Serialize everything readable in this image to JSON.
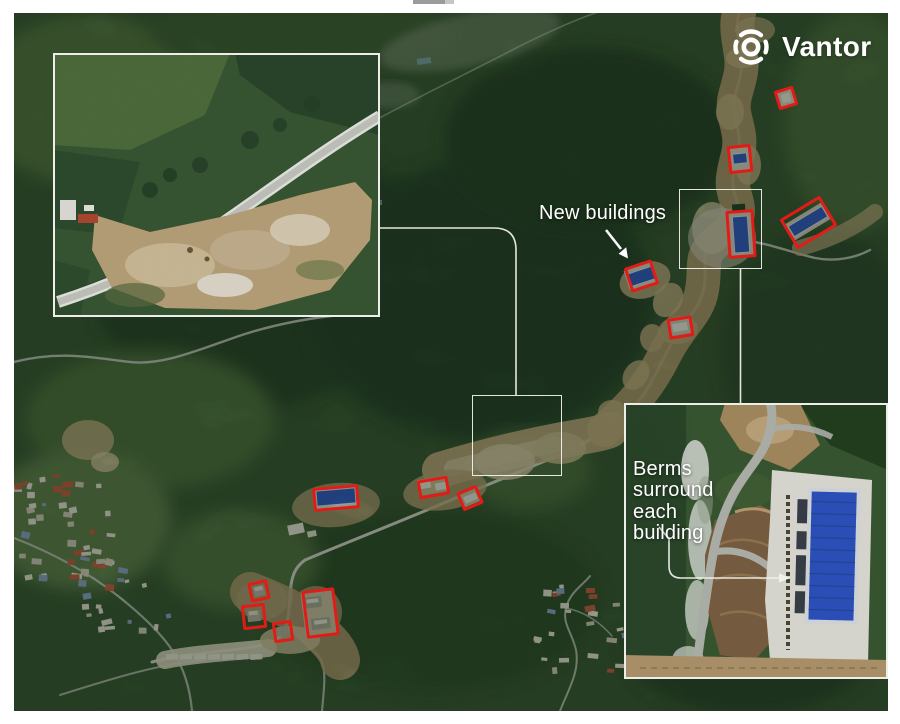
{
  "page": {
    "background_color": "#ffffff"
  },
  "logo": {
    "text": "Vantor",
    "icon": "vantor-aperture-icon",
    "color": "#ffffff"
  },
  "annotations": {
    "new_buildings_label": "New buildings",
    "berms_label": "Berms surround each building",
    "highlight_color": "#e31b17",
    "callout_color": "#f2f3ee",
    "red_boxes": [
      {
        "cx": 786,
        "cy": 98,
        "w": 20,
        "h": 20,
        "rot": -17
      },
      {
        "cx": 740,
        "cy": 159,
        "w": 24,
        "h": 28,
        "rot": -6
      },
      {
        "cx": 741,
        "cy": 234,
        "w": 28,
        "h": 48,
        "rot": -4
      },
      {
        "cx": 808,
        "cy": 222,
        "w": 47,
        "h": 35,
        "rot": -31
      },
      {
        "cx": 641,
        "cy": 276,
        "w": 29,
        "h": 26,
        "rot": -18
      },
      {
        "cx": 680,
        "cy": 327,
        "w": 25,
        "h": 21,
        "rot": -9
      },
      {
        "cx": 336,
        "cy": 498,
        "w": 46,
        "h": 24,
        "rot": -5
      },
      {
        "cx": 433,
        "cy": 487,
        "w": 31,
        "h": 19,
        "rot": -10
      },
      {
        "cx": 470,
        "cy": 498,
        "w": 22,
        "h": 20,
        "rot": -23
      },
      {
        "cx": 259,
        "cy": 591,
        "w": 20,
        "h": 20,
        "rot": -12
      },
      {
        "cx": 254,
        "cy": 616,
        "w": 24,
        "h": 25,
        "rot": -6
      },
      {
        "cx": 283,
        "cy": 631,
        "w": 20,
        "h": 21,
        "rot": -8
      },
      {
        "cx": 320,
        "cy": 613,
        "w": 33,
        "h": 48,
        "rot": -7
      }
    ],
    "link_boxes": [
      {
        "cx": 720.5,
        "cy": 229,
        "w": 83,
        "h": 80
      },
      {
        "cx": 517,
        "cy": 435.5,
        "w": 90,
        "h": 81
      }
    ],
    "inset_frames": [
      {
        "x": 53,
        "y": 53,
        "w": 327,
        "h": 264
      },
      {
        "x": 624,
        "y": 403,
        "w": 264,
        "h": 276
      }
    ]
  }
}
